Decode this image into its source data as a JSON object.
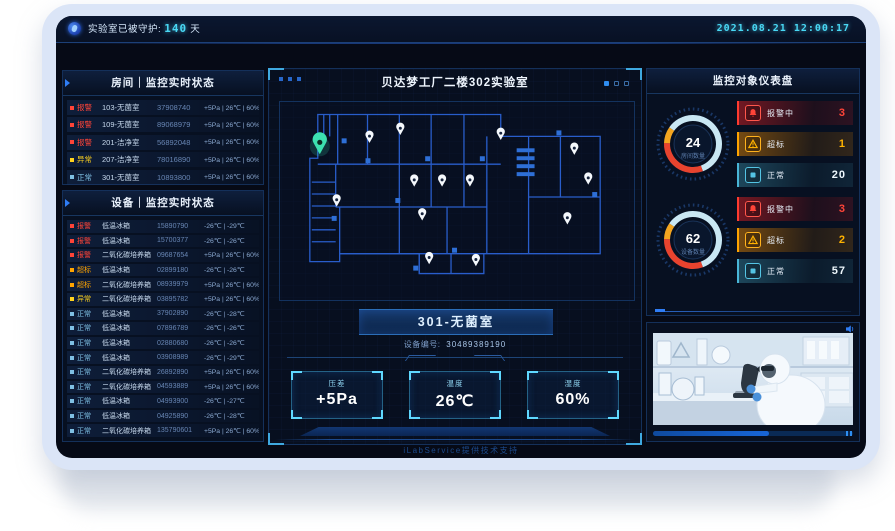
{
  "top_bar": {
    "guard_label": "实验室已被守护:",
    "guard_days": "140",
    "guard_unit": "天",
    "datetime": "2021.08.21 12:00:17"
  },
  "rooms_panel": {
    "title": "房间｜监控实时状态",
    "rows": [
      {
        "level": "alarm",
        "status": "报警",
        "name": "103-无菌室",
        "code": "37908740",
        "metrics": "+5Pa | 26℃ | 60%"
      },
      {
        "level": "alarm",
        "status": "报警",
        "name": "109-无菌室",
        "code": "89068979",
        "metrics": "+5Pa | 26℃ | 60%"
      },
      {
        "level": "alarm",
        "status": "报警",
        "name": "201-洁净室",
        "code": "56892048",
        "metrics": "+5Pa | 26℃ | 60%"
      },
      {
        "level": "abnormal",
        "status": "异常",
        "name": "207-洁净室",
        "code": "78016890",
        "metrics": "+5Pa | 26℃ | 60%"
      },
      {
        "level": "normal",
        "status": "正常",
        "name": "301-无菌室",
        "code": "10893800",
        "metrics": "+5Pa | 26℃ | 60%"
      }
    ]
  },
  "devices_panel": {
    "title": "设备｜监控实时状态",
    "rows": [
      {
        "level": "alarm",
        "status": "报警",
        "name": "低温冰箱",
        "code": "15890790",
        "metrics": "-26℃ | -29℃"
      },
      {
        "level": "alarm",
        "status": "报警",
        "name": "低温冰箱",
        "code": "15700377",
        "metrics": "-26℃ | -26℃"
      },
      {
        "level": "alarm",
        "status": "报警",
        "name": "二氧化碳培养箱",
        "code": "09687654",
        "metrics": "+5Pa | 26℃ | 60%"
      },
      {
        "level": "over",
        "status": "超标",
        "name": "低温冰箱",
        "code": "02899180",
        "metrics": "-26℃ | -26℃"
      },
      {
        "level": "over",
        "status": "超标",
        "name": "二氧化碳培养箱",
        "code": "08939979",
        "metrics": "+5Pa | 26℃ | 60%"
      },
      {
        "level": "abnormal",
        "status": "异常",
        "name": "二氧化碳培养箱",
        "code": "03895782",
        "metrics": "+5Pa | 26℃ | 60%"
      },
      {
        "level": "normal",
        "status": "正常",
        "name": "低温冰箱",
        "code": "37902890",
        "metrics": "-26℃ | -28℃"
      },
      {
        "level": "normal",
        "status": "正常",
        "name": "低温冰箱",
        "code": "07896789",
        "metrics": "-26℃ | -26℃"
      },
      {
        "level": "normal",
        "status": "正常",
        "name": "低温冰箱",
        "code": "02880680",
        "metrics": "-26℃ | -26℃"
      },
      {
        "level": "normal",
        "status": "正常",
        "name": "低温冰箱",
        "code": "03908989",
        "metrics": "-26℃ | -29℃"
      },
      {
        "level": "normal",
        "status": "正常",
        "name": "二氧化碳培养箱",
        "code": "26892890",
        "metrics": "+5Pa | 26℃ | 60%"
      },
      {
        "level": "normal",
        "status": "正常",
        "name": "二氧化碳培养箱",
        "code": "04593889",
        "metrics": "+5Pa | 26℃ | 60%"
      },
      {
        "level": "normal",
        "status": "正常",
        "name": "低温冰箱",
        "code": "04993900",
        "metrics": "-26℃ | -27℃"
      },
      {
        "level": "normal",
        "status": "正常",
        "name": "低温冰箱",
        "code": "04925890",
        "metrics": "-26℃ | -28℃"
      },
      {
        "level": "normal",
        "status": "正常",
        "name": "二氧化碳培养箱",
        "code": "135790601",
        "metrics": "+5Pa | 26℃ | 60%"
      }
    ]
  },
  "center_panel": {
    "title": "贝达梦工厂二楼302实验室",
    "room_label": "301-无菌室",
    "device_no_label": "设备编号:",
    "device_no": "30489389190",
    "pagination_dots": 3,
    "active_dot": 0,
    "metrics": [
      {
        "label": "压差",
        "value": "+5Pa"
      },
      {
        "label": "温度",
        "value": "26℃"
      },
      {
        "label": "湿度",
        "value": "60%"
      }
    ]
  },
  "dashboard_panel": {
    "title": "监控对象仪表盘",
    "gauges": [
      {
        "value": "24",
        "label": "房间数量",
        "stats": [
          {
            "level": "alarm",
            "label": "报警中",
            "value": "3"
          },
          {
            "level": "over",
            "label": "超标",
            "value": "1"
          },
          {
            "level": "normal",
            "label": "正常",
            "value": "20"
          }
        ]
      },
      {
        "value": "62",
        "label": "设备数量",
        "stats": [
          {
            "level": "alarm",
            "label": "报警中",
            "value": "3"
          },
          {
            "level": "over",
            "label": "超标",
            "value": "2"
          },
          {
            "level": "normal",
            "label": "正常",
            "value": "57"
          }
        ]
      }
    ]
  },
  "video_panel": {
    "progress_percent": 58
  },
  "footer": {
    "text": "iLabService提供技术支持"
  },
  "status_colors": {
    "alarm": "#ff4438",
    "over": "#ffa400",
    "abnormal": "#ffd21e",
    "normal": "#6ec6e8",
    "accent": "#2f7df5"
  }
}
